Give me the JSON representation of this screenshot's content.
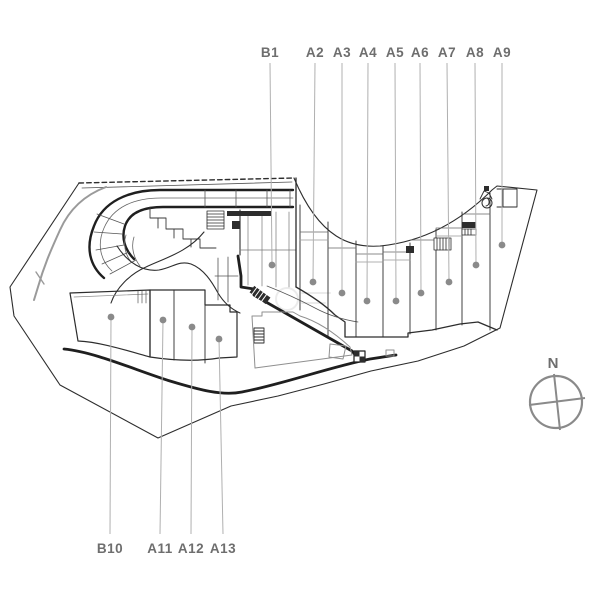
{
  "plan_title": "site-plan",
  "callouts": {
    "top_label_y": 57,
    "top_line_start_y": 63,
    "bottom_label_y": 553,
    "bottom_line_end_y": 534,
    "top": [
      {
        "label": "B1",
        "x": 270,
        "dot_x": 272,
        "dot_y": 265
      },
      {
        "label": "A2",
        "x": 315,
        "dot_x": 313,
        "dot_y": 282
      },
      {
        "label": "A3",
        "x": 342,
        "dot_x": 342,
        "dot_y": 293
      },
      {
        "label": "A4",
        "x": 368,
        "dot_x": 367,
        "dot_y": 301
      },
      {
        "label": "A5",
        "x": 395,
        "dot_x": 396,
        "dot_y": 301
      },
      {
        "label": "A6",
        "x": 420,
        "dot_x": 421,
        "dot_y": 293
      },
      {
        "label": "A7",
        "x": 447,
        "dot_x": 449,
        "dot_y": 282
      },
      {
        "label": "A8",
        "x": 475,
        "dot_x": 476,
        "dot_y": 265
      },
      {
        "label": "A9",
        "x": 502,
        "dot_x": 502,
        "dot_y": 245
      }
    ],
    "bottom": [
      {
        "label": "B10",
        "x": 110,
        "dot_x": 111,
        "dot_y": 317
      },
      {
        "label": "A11",
        "x": 160,
        "dot_x": 163,
        "dot_y": 320
      },
      {
        "label": "A12",
        "x": 191,
        "dot_x": 192,
        "dot_y": 327
      },
      {
        "label": "A13",
        "x": 223,
        "dot_x": 219,
        "dot_y": 339
      }
    ]
  },
  "compass": {
    "label": "N"
  },
  "colors": {
    "plan_line": "#2d2d2d",
    "thick_line": "#1f1f1f",
    "light_line": "#8f8f8f",
    "leader_line": "#b0b0b0",
    "dot": "#8a8a8a",
    "label_text": "#6e6e6e",
    "compass": "#8a8a8a"
  }
}
